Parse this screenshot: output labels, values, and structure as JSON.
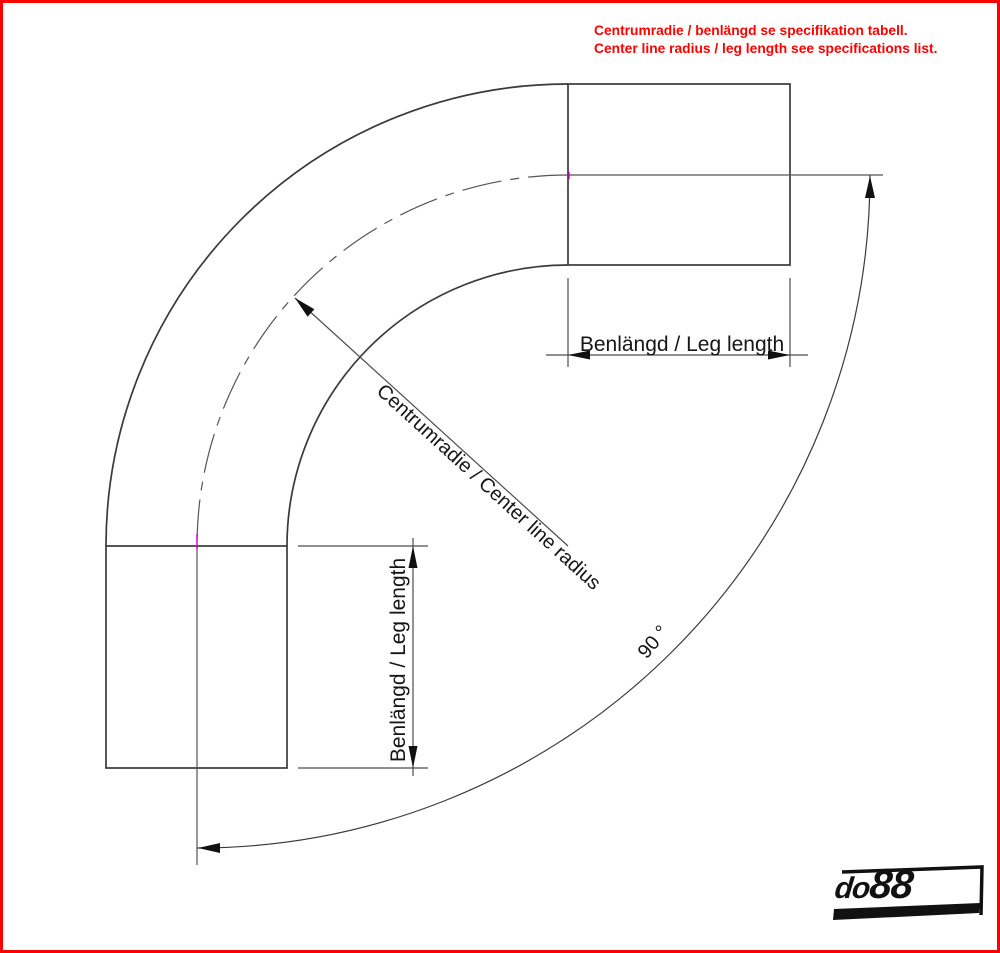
{
  "notes": {
    "line1_sv": "Centrumradie / benlängd se specifikation tabell.",
    "line2_en": "Center line radius / leg length see specifications list."
  },
  "labels": {
    "leg_length_top": "Benlängd / Leg length",
    "leg_length_left": "Benlängd / Leg length",
    "center_radius": "Centrumradie / Center line radius",
    "angle": "90 °"
  },
  "logo": {
    "full": "do88",
    "part1": "do",
    "part2": "88"
  },
  "colors": {
    "border": "#ff0000",
    "note_text": "#ff0000",
    "drawing_line": "#3a3a3a",
    "dimension_line": "#4d4d4d",
    "centerline_tick": "#c800c8",
    "logo": "#111111"
  }
}
